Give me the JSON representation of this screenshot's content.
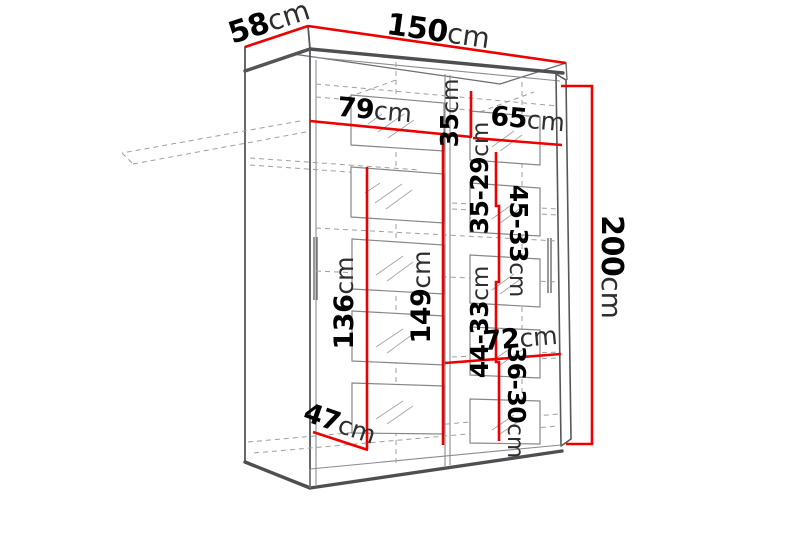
{
  "diagram": {
    "title": "Sliding-door wardrobe dimension drawing",
    "colors": {
      "dimension_line": "#ee0000",
      "outline": "#55575a",
      "hidden_line": "#9d9fa2",
      "label_text": "#000000",
      "background": "#ffffff"
    },
    "dimensions": {
      "depth": {
        "num": "58",
        "unit": "cm"
      },
      "width": {
        "num": "150",
        "unit": "cm"
      },
      "height": {
        "num": "200",
        "unit": "cm"
      },
      "left_section_width": {
        "num": "79",
        "unit": "cm"
      },
      "top_shelf_height": {
        "num": "35",
        "unit": "cm"
      },
      "right_section_width": {
        "num": "65",
        "unit": "cm"
      },
      "right_shelf_1": {
        "num": "35-29",
        "unit": "cm"
      },
      "right_shelf_2": {
        "num": "45-33",
        "unit": "cm"
      },
      "right_shelf_3": {
        "num": "44-33",
        "unit": "cm"
      },
      "right_shelf_4": {
        "num": "36-30",
        "unit": "cm"
      },
      "left_interior_height": {
        "num": "136",
        "unit": "cm"
      },
      "interior_height": {
        "num": "149",
        "unit": "cm"
      },
      "lower_shelf_width": {
        "num": "72",
        "unit": "cm"
      },
      "interior_depth": {
        "num": "47",
        "unit": "cm"
      }
    }
  }
}
